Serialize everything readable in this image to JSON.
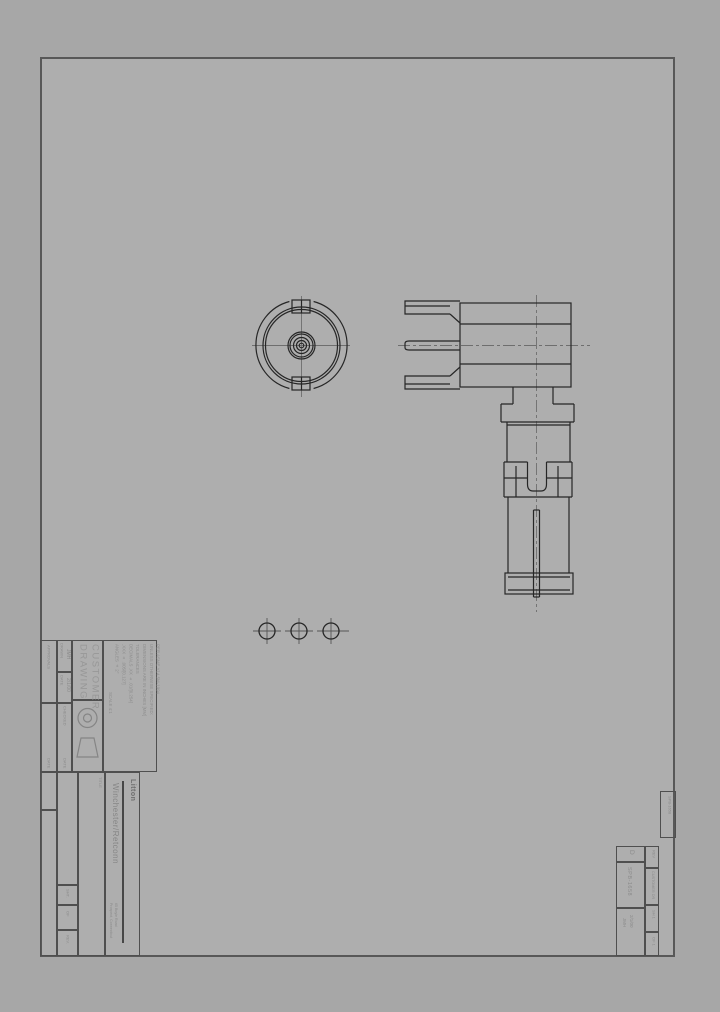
{
  "colors": {
    "paper": "#aeaeae",
    "background": "#a7a7a7",
    "line": "#262626",
    "border": "#585858",
    "text": "#8b8b8b"
  },
  "title_block": {
    "approvals_header": "APPROVALS",
    "drawn_label": "DRAWN",
    "drawn_value": "JMH",
    "date_label": "DATE",
    "date_value": "2/1/00",
    "checked_label": "CHECKED",
    "checked_date_label": "DATE",
    "approvals_date_label": "DATE",
    "title_line1": "CUSTOMER",
    "title_line2": "DRAWING",
    "notes": [
      "PER ASME Y14.5M-1994",
      "UNLESS OTHERWISE SPECIFIED:",
      "DIMENSIONS ARE IN INCHES [MM]",
      "TOLERANCES",
      "DECIMALS  .XX ± .01/[0.254]",
      ".XXX ± .005/[0.127]",
      "ANGLES ± 2°"
    ],
    "scale_label": "SCALE  4:1",
    "title_label": "TITLE",
    "sht_label": "SHT.",
    "of_label": "OF",
    "rev_label": "REV."
  },
  "company": {
    "logo": "Litton",
    "name": "Winchester/Retconn",
    "address_line1": "65 Boyle Road",
    "address_line2": "Prospect, Connecticut"
  },
  "number_block": {
    "size": "D",
    "dwg_no": "SPB-1658",
    "date": "2/1/00",
    "drawn_by": "JMH",
    "rev_label": "REV",
    "doc_type": "CUSTOMER DR",
    "sheet_label": "SH 1",
    "of_label": "OF 1"
  },
  "edge_label": "SPB-1658"
}
